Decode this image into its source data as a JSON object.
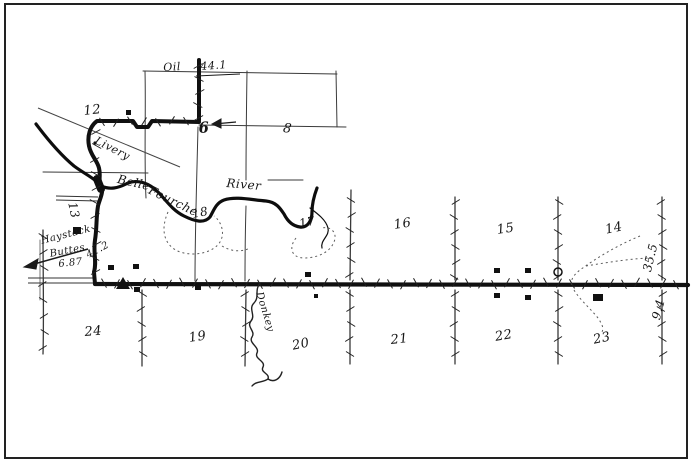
{
  "labels": {
    "oil": "Oil",
    "mile_top": "44.1",
    "livery": "Livery",
    "river_1": "Belle",
    "river_2": "Fourche",
    "river_3": "River",
    "creek": "Donkey",
    "dir_1": "Haystack",
    "dir_2": "Buttes",
    "mile_left_a": "6.87",
    "mile_left_b": "41.2",
    "mile_right_top": "35.5",
    "mile_right_bottom": "9.4"
  },
  "sections": {
    "s6": "6",
    "s8": "8",
    "s12": "12",
    "s13": "13",
    "s14": "14",
    "s15": "15",
    "s16": "16",
    "s17": "17",
    "s18": "18",
    "s19": "19",
    "s20": "20",
    "s21": "21",
    "s22": "22",
    "s23": "23",
    "s24": "24"
  },
  "colors": {
    "ink": "#1b1b1b",
    "paper": "#ffffff",
    "frame_border": "#222222",
    "faint_line": "#555555"
  }
}
